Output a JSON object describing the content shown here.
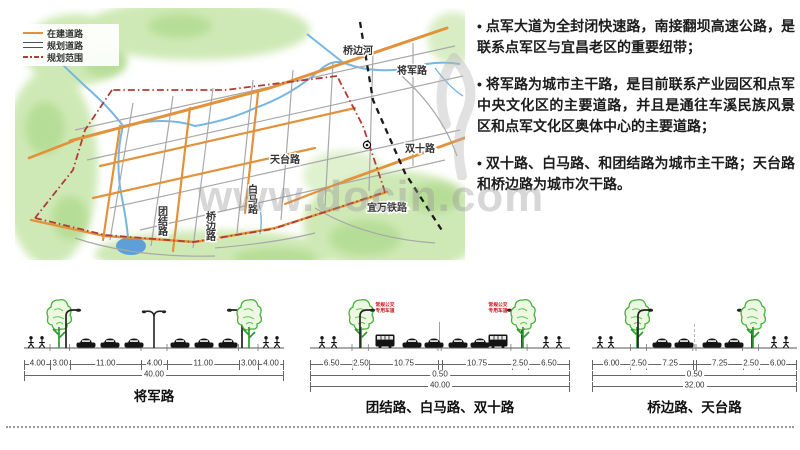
{
  "slide": {
    "bullet_char": "•"
  },
  "legend": {
    "items": [
      {
        "label": "在建道路"
      },
      {
        "label": "规划道路"
      },
      {
        "label": "规划范围"
      }
    ]
  },
  "map": {
    "labels": {
      "qiaobian_river": "桥边河",
      "jiangjun_road": "将军路",
      "shuangshi_road": "双十路",
      "tiantai_road": "天台路",
      "baima_road": "白马路",
      "qiaobian_road": "桥边路",
      "tuanjie_road": "团结路",
      "yiwan_railway": "宜万铁路"
    },
    "colors": {
      "road_construction": "#e2923b",
      "road_planned": "#a8a8a8",
      "boundary": "#b23b35",
      "water": "#6fb3e3",
      "terrain": "#cfe9b6"
    }
  },
  "bullets": [
    {
      "text": "点军大道为全封闭快速路，南接翻坝高速公路，是联系点军区与宜昌老区的重要纽带；"
    },
    {
      "text": "将军路为城市主干路，是目前联系产业园区和点军中央文化区的主要道路，并且是通往车溪民族风景区和点军文化区奥体中心的主要道路；"
    },
    {
      "text": "双十路、白马路、和团结路为城市主干路；天台路和桥边路为城市次干路。"
    }
  ],
  "watermark": {
    "text": "www.docin.com"
  },
  "sections": [
    {
      "title": "将军路",
      "widths": [
        4,
        3,
        11,
        4,
        11,
        3,
        4
      ],
      "dims": [
        "4.00",
        "3.00",
        "11.00",
        "4.00",
        "11.00",
        "3.00",
        "4.00"
      ],
      "mid": "",
      "total": "40.00"
    },
    {
      "title": "团结路、白马路、双十路",
      "widths": [
        6.5,
        2.5,
        10.75,
        0.5,
        10.75,
        2.5,
        6.5
      ],
      "dims": [
        "6.50",
        "2.50",
        "10.75",
        "",
        "10.75",
        "2.50",
        "6.50"
      ],
      "mid": "0.50",
      "total": "40.00",
      "bus_label_line1": "常规公交",
      "bus_label_line2": "专用车道"
    },
    {
      "title": "桥边路、天台路",
      "widths": [
        6,
        2.5,
        7.25,
        0.5,
        7.25,
        2.5,
        6
      ],
      "dims": [
        "6.00",
        "2.50",
        "7.25",
        "",
        "7.25",
        "2.50",
        "6.00"
      ],
      "mid": "0.50",
      "total": "32.00"
    }
  ]
}
